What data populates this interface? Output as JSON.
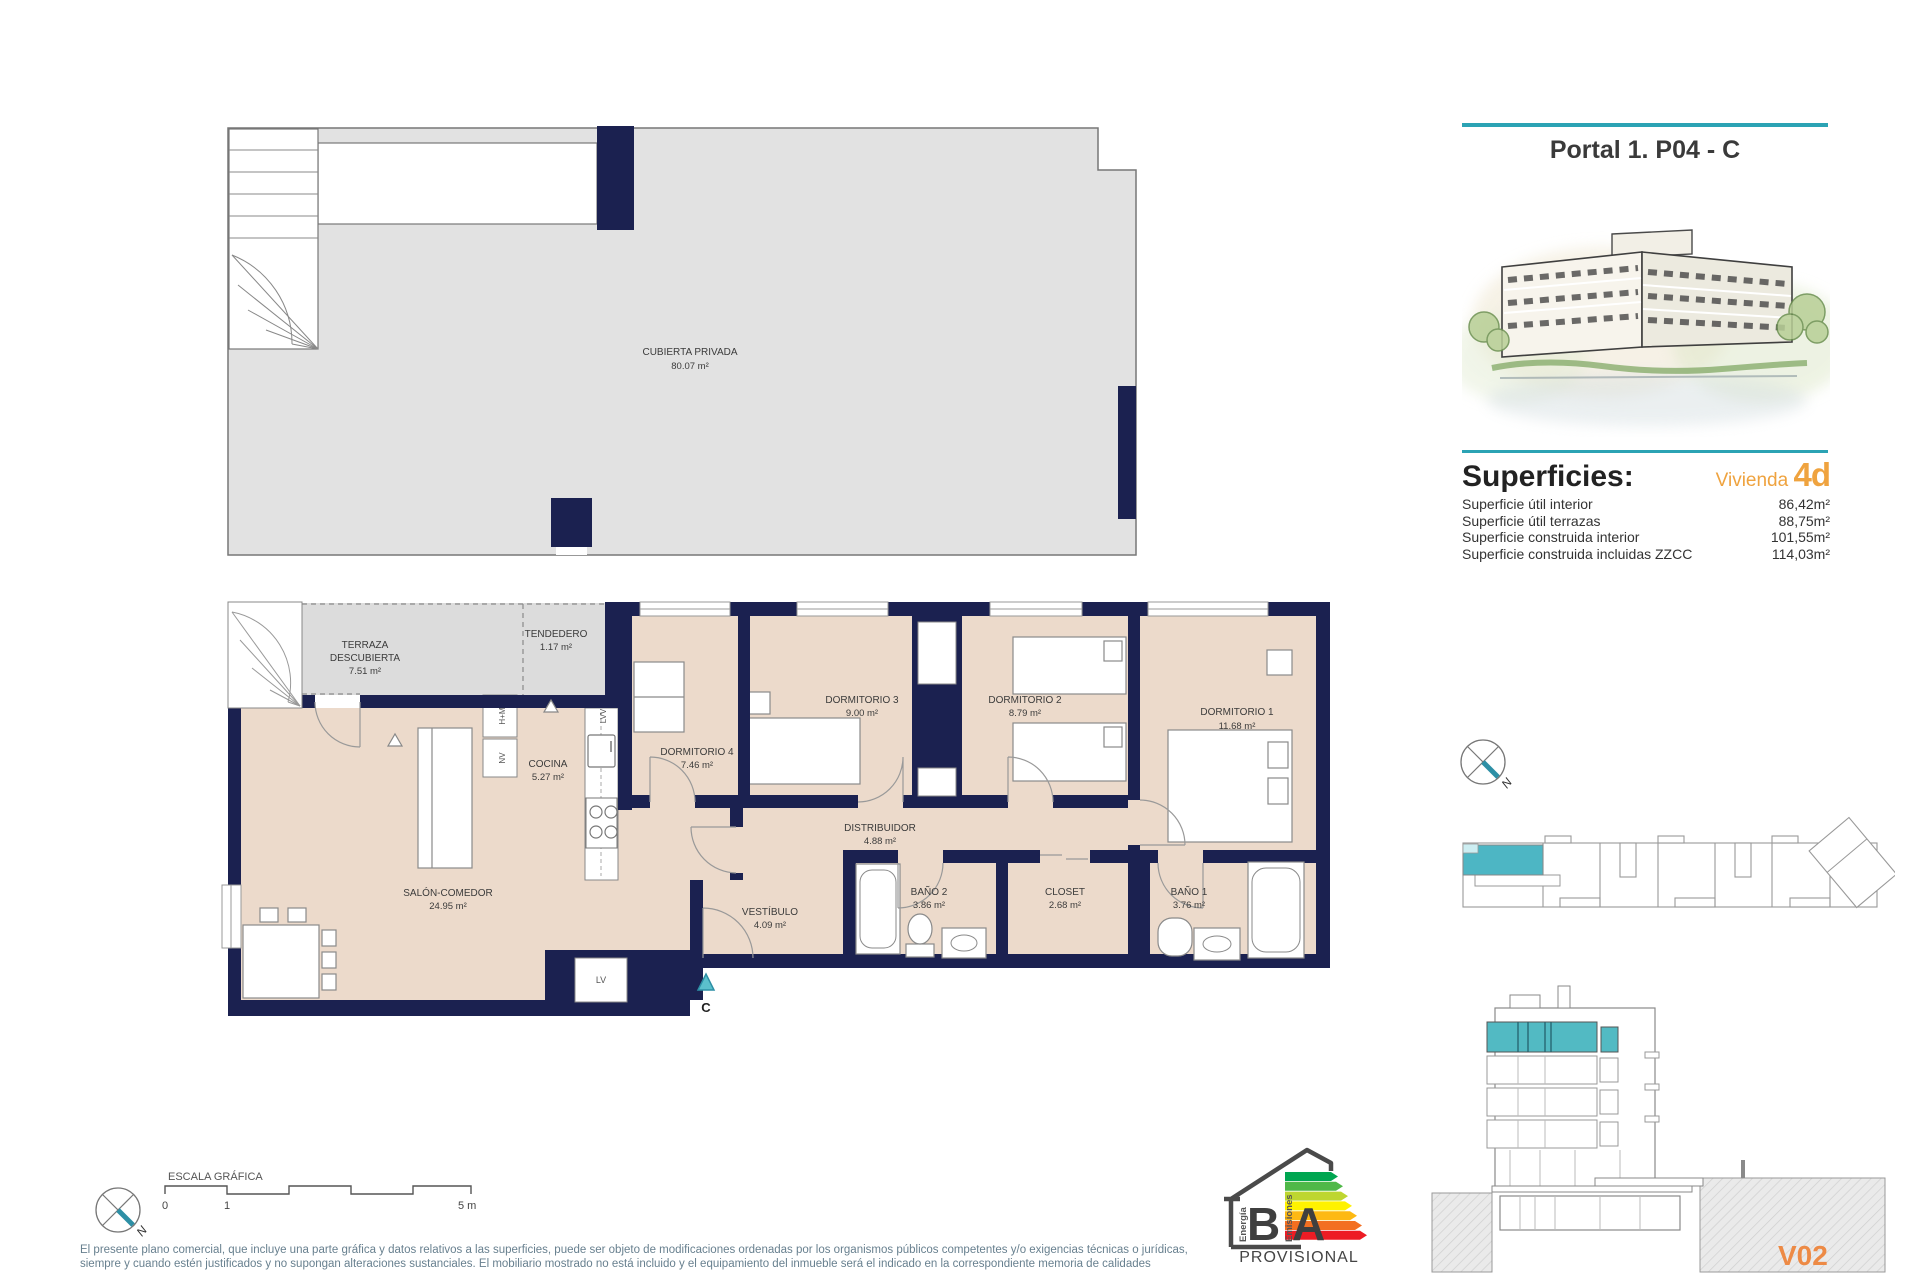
{
  "sheet": {
    "title": "Portal 1. P04 - C",
    "version": "V02"
  },
  "superficies": {
    "heading": "Superficies:",
    "vivienda_label": "Vivienda",
    "vivienda_code": "4d",
    "rows": [
      {
        "label": "Superficie útil interior",
        "value": "86,42m²"
      },
      {
        "label": "Superficie útil terrazas",
        "value": "88,75m²"
      },
      {
        "label": "Superficie construida interior",
        "value": "101,55m²"
      },
      {
        "label": "Superficie construida incluidas ZZCC",
        "value": "114,03m²"
      }
    ]
  },
  "roof_plan": {
    "name": "CUBIERTA PRIVADA",
    "area": "80.07 m²"
  },
  "floor_plan": {
    "rooms": [
      {
        "name": "TERRAZA",
        "name2": "DESCUBIERTA",
        "area": "7.51 m²"
      },
      {
        "name": "TENDEDERO",
        "area": "1.17 m²"
      },
      {
        "name": "COCINA",
        "area": "5.27 m²"
      },
      {
        "name": "DORMITORIO 4",
        "area": "7.46 m²"
      },
      {
        "name": "DORMITORIO 3",
        "area": "9.00 m²"
      },
      {
        "name": "DORMITORIO 2",
        "area": "8.79 m²"
      },
      {
        "name": "DORMITORIO 1",
        "area": "11.68 m²"
      },
      {
        "name": "DISTRIBUIDOR",
        "area": "4.88 m²"
      },
      {
        "name": "SALÓN-COMEDOR",
        "area": "24.95 m²"
      },
      {
        "name": "VESTÍBULO",
        "area": "4.09 m²"
      },
      {
        "name": "BAÑO 2",
        "area": "3.86 m²"
      },
      {
        "name": "CLOSET",
        "area": "2.68 m²"
      },
      {
        "name": "BAÑO 1",
        "area": "3.76 m²"
      }
    ],
    "appliances": {
      "hm": "H+M",
      "nv": "NV",
      "lvv": "LVV",
      "lv": "LV"
    },
    "entrance": "C"
  },
  "compass": {
    "label": "N"
  },
  "scale_bar": {
    "title": "ESCALA GRÁFICA",
    "ticks": [
      "0",
      "1",
      "5 m"
    ]
  },
  "energy": {
    "letter_b": "B",
    "letter_a": "A",
    "word_left": "Energía",
    "word_right": "Emisiones",
    "status": "PROVISIONAL"
  },
  "footer": {
    "line1": "El presente plano comercial, que incluye una parte gráfica y datos relativos a las superficies, puede ser objeto de modificaciones ordenadas por los organismos públicos competentes y/o exigencias técnicas o jurídicas,",
    "line2": "siempre y cuando estén justificados y no supongan alteraciones sustanciales. El mobiliario mostrado no está incluido y el equipamiento del inmueble será el indicado en la correspondiente memoria de calidades"
  },
  "colors": {
    "accent_teal": "#2ba3b4",
    "unit_teal": "#4db6c4",
    "wall_navy": "#1b2150",
    "room_beige": "#ecdacb",
    "accent_orange": "#efa33f",
    "version_orange": "#ed8a45"
  }
}
